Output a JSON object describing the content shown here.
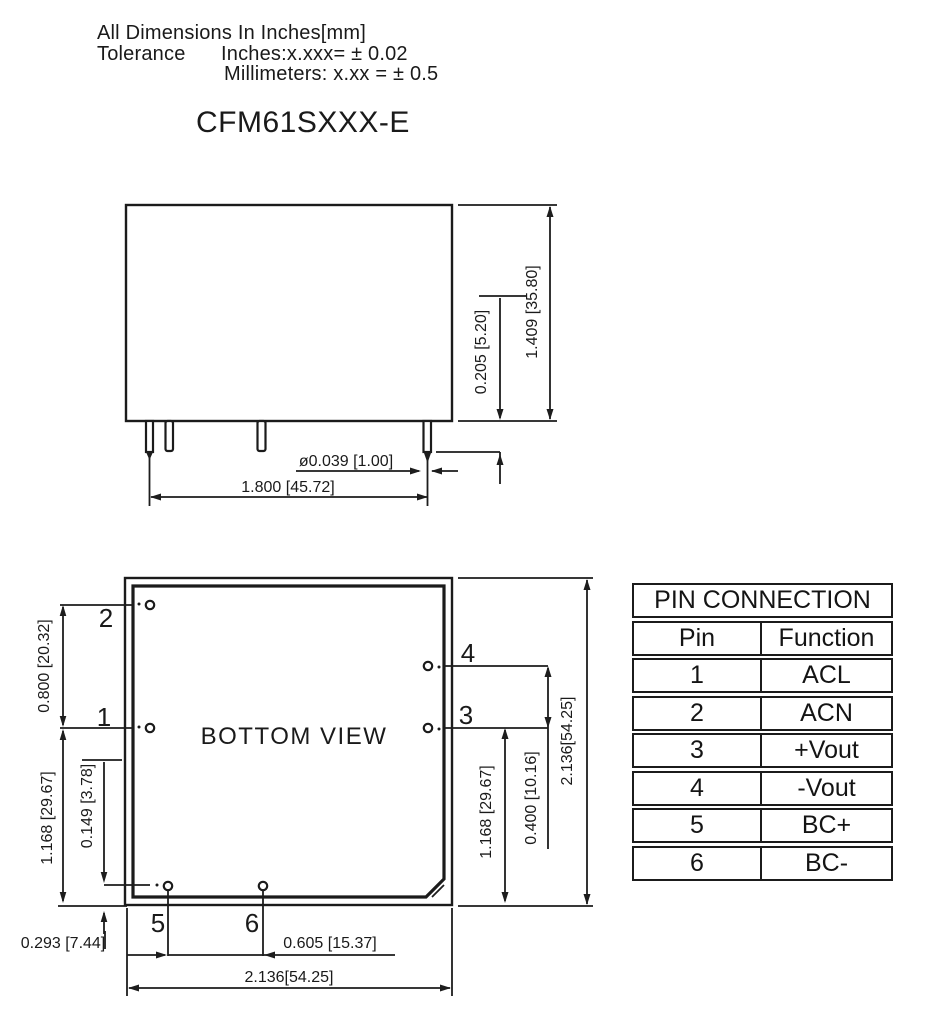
{
  "header": {
    "line1": "All Dimensions In Inches[mm]",
    "tolerance_label": "Tolerance",
    "tolerance_inches": "Inches:x.xxx= ± 0.02",
    "tolerance_mm": "Millimeters: x.xx = ± 0.5",
    "title": "CFM61SXXX-E"
  },
  "side_view": {
    "dim_pin_diameter": "ø0.039 [1.00]",
    "dim_pin_span": "1.800 [45.72]",
    "dim_pin_standoff": "0.205 [5.20]",
    "dim_total_height": "1.409 [35.80]"
  },
  "bottom_view": {
    "label": "BOTTOM VIEW",
    "pin1": "1",
    "pin2": "2",
    "pin3": "3",
    "pin4": "4",
    "pin5": "5",
    "pin6": "6",
    "dim_pin1_pin2": "0.800 [20.32]",
    "dim_left_height": "1.168 [29.67]",
    "dim_pin5_inset_x": "0.149 [3.78]",
    "dim_pin5_inset_y": "0.293 [7.44]",
    "dim_pin5_pin6": "0.605 [15.37]",
    "dim_width": "2.136[54.25]",
    "dim_pin3_pin4": "0.400 [10.16]",
    "dim_right_height": "1.168 [29.67]",
    "dim_height": "2.136[54.25]"
  },
  "pin_table": {
    "title": "PIN CONNECTION",
    "col_pin": "Pin",
    "col_function": "Function",
    "rows": [
      {
        "pin": "1",
        "function": "ACL"
      },
      {
        "pin": "2",
        "function": "ACN"
      },
      {
        "pin": "3",
        "function": "+Vout"
      },
      {
        "pin": "4",
        "function": "-Vout"
      },
      {
        "pin": "5",
        "function": "BC+"
      },
      {
        "pin": "6",
        "function": "BC-"
      }
    ]
  },
  "colors": {
    "ink": "#1b1b1b",
    "background": "#ffffff"
  }
}
